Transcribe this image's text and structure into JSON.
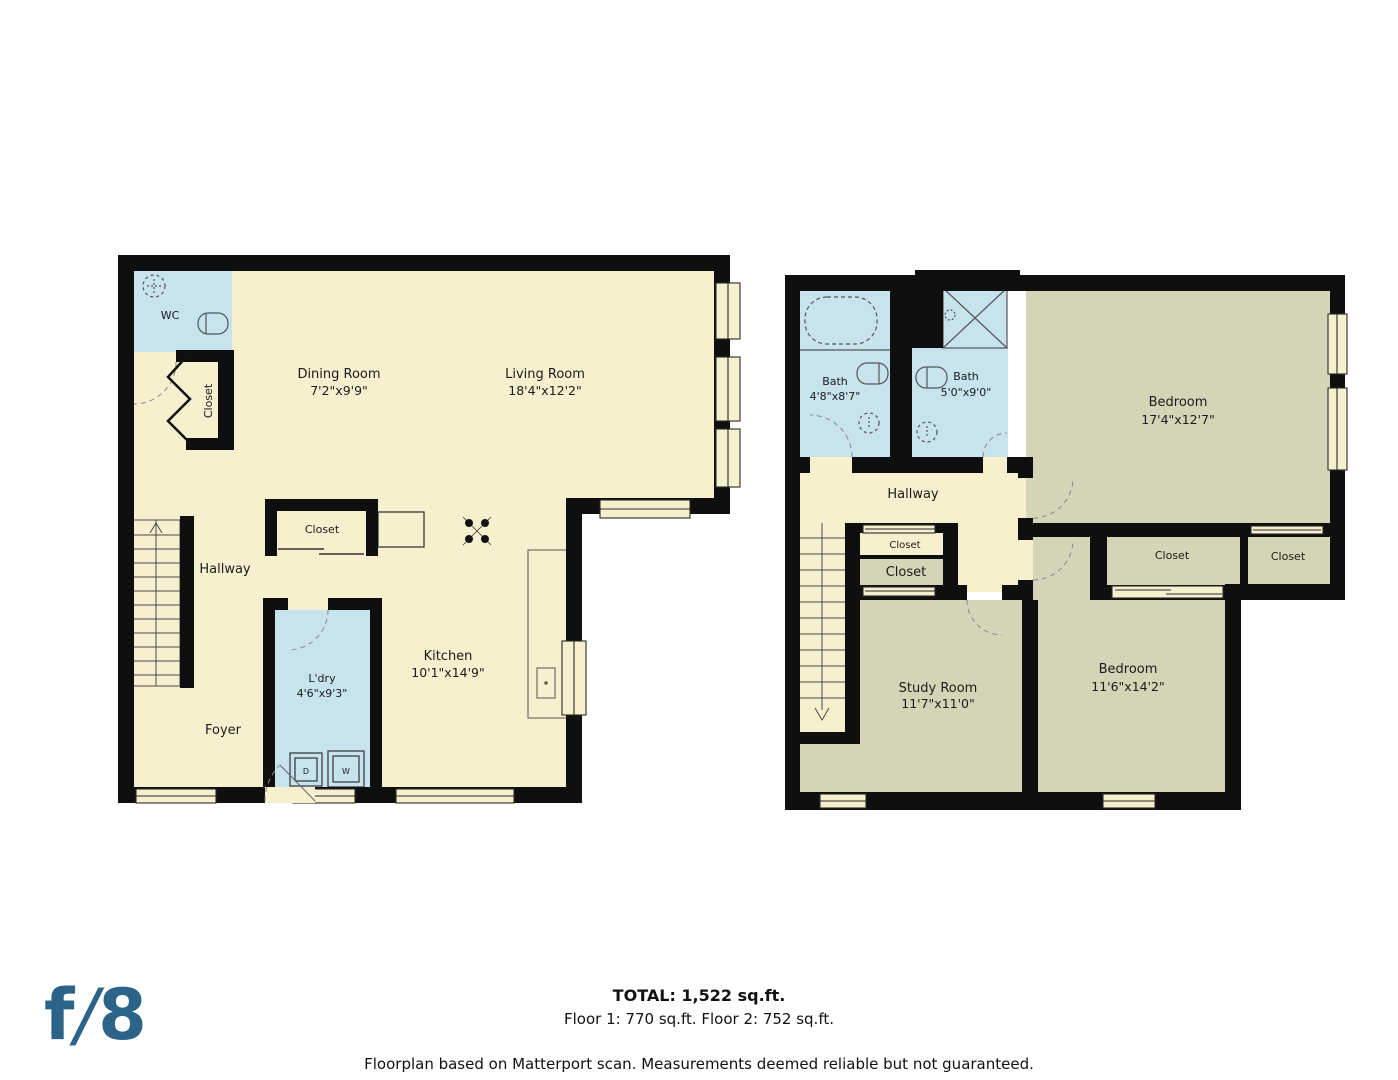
{
  "floor1": {
    "wc": {
      "label": "WC"
    },
    "hall_closet": {
      "label": "Closet"
    },
    "dining": {
      "label": "Dining Room",
      "dims": "7'2\"x9'9\""
    },
    "living": {
      "label": "Living Room",
      "dims": "18'4\"x12'2\""
    },
    "kitchen_closet": {
      "label": "Closet"
    },
    "hallway": {
      "label": "Hallway"
    },
    "kitchen": {
      "label": "Kitchen",
      "dims": "10'1\"x14'9\""
    },
    "laundry": {
      "label": "L'dry",
      "dims": "4'6\"x9'3\""
    },
    "foyer": {
      "label": "Foyer"
    },
    "dryer": "D",
    "washer": "W"
  },
  "floor2": {
    "bath1": {
      "label": "Bath",
      "dims": "4'8\"x8'7\""
    },
    "bath2": {
      "label": "Bath",
      "dims": "5'0\"x9'0\""
    },
    "bedroom1": {
      "label": "Bedroom",
      "dims": "17'4\"x12'7\""
    },
    "hallway": {
      "label": "Hallway"
    },
    "closet_a": {
      "label": "Closet"
    },
    "closet_b": {
      "label": "Closet"
    },
    "closet_c": {
      "label": "Closet"
    },
    "closet_d": {
      "label": "Closet"
    },
    "study": {
      "label": "Study Room",
      "dims": "11'7\"x11'0\""
    },
    "bedroom2": {
      "label": "Bedroom",
      "dims": "11'6\"x14'2\""
    }
  },
  "footer": {
    "total": "TOTAL: 1,522 sq.ft.",
    "floors": "Floor 1: 770 sq.ft. Floor 2: 752 sq.ft.",
    "disclaimer": "Floorplan based on Matterport scan. Measurements deemed reliable but not guaranteed."
  },
  "logo": {
    "f": "f",
    "slash": "/",
    "eight": "8"
  },
  "colors": {
    "floor_cream": "#f7f0cf",
    "wet_blue": "#c6e3ee",
    "room_olive": "#d4d4b7",
    "wall": "#0f0f0f",
    "logo_blue": "#2b6389"
  }
}
